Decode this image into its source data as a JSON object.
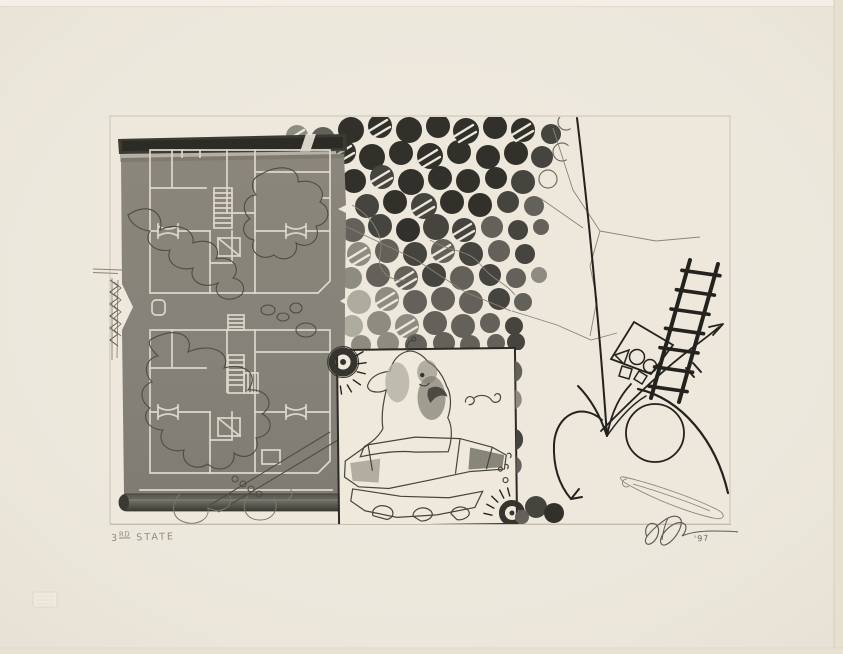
{
  "artwork": {
    "inscription": {
      "number": "3",
      "suffix": "RD",
      "word": "STATE"
    },
    "signature_year": "'97",
    "palette": {
      "paper": "#ece7db",
      "plate_tone": "#ede8db",
      "panel_gray": "#85827a",
      "plan_line": "#dcd7ca",
      "ink_black": "#23221e",
      "dot_dark": "#31302b",
      "dot_mid": "#63615a",
      "dot_pale": "#aeab9f",
      "wash_gray": "#918e82",
      "pencil": "#8f897e"
    }
  }
}
